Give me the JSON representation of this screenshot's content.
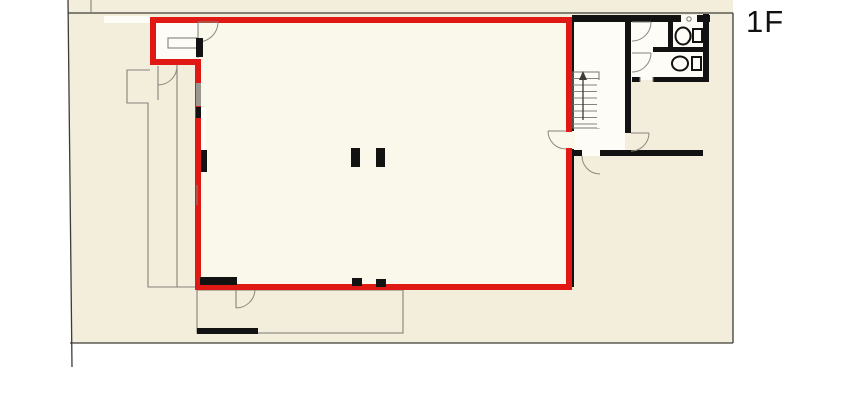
{
  "floor_label": "1F",
  "colors": {
    "page": "#ffffff",
    "site": "#f3eedc",
    "room": "#faf7eb",
    "room_white": "#fdfcf6",
    "red": "#e01915",
    "wall": "#121212",
    "thin": "#3d3c37",
    "gray": "#84827a",
    "label": "#111111"
  }
}
